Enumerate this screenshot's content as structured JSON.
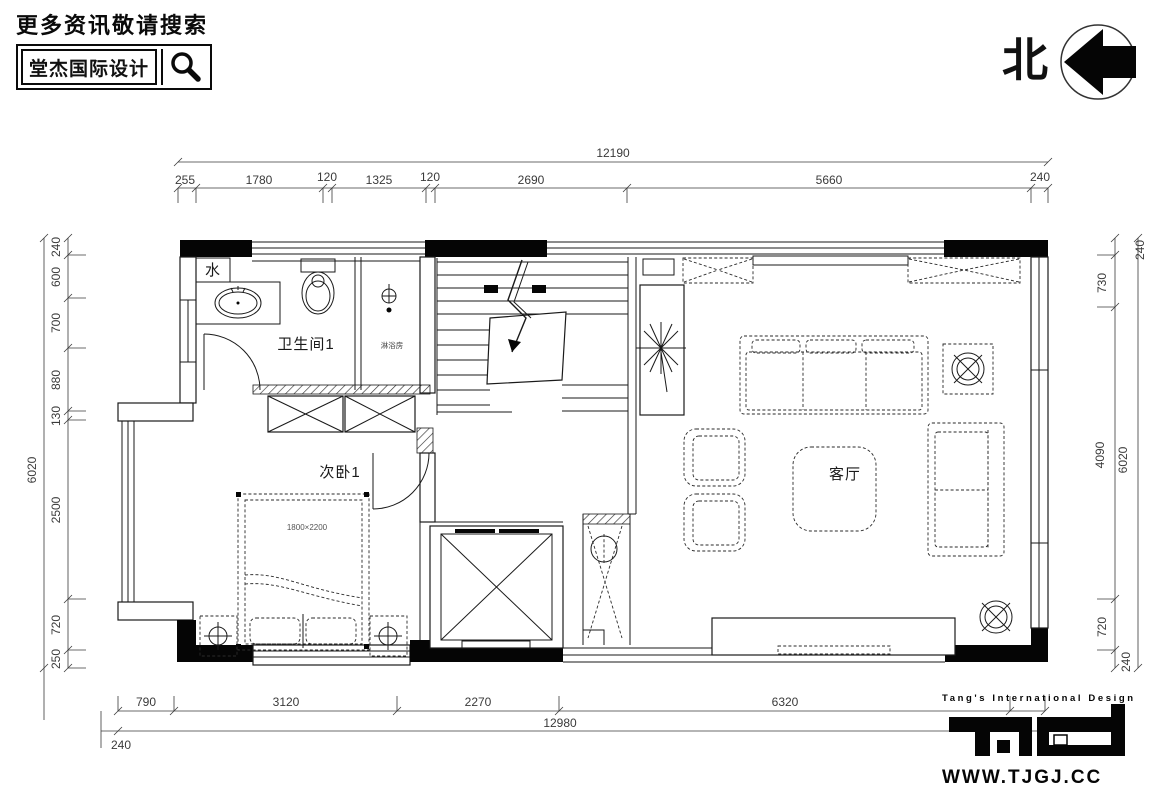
{
  "header": {
    "search_hint": "更多资讯敬请搜索",
    "brand": "堂杰国际设计"
  },
  "compass": {
    "label": "北"
  },
  "icons": {
    "search": "magnifier",
    "compass_arrow": "left-arrow-in-circle"
  },
  "colors": {
    "ink": "#1a1a1a",
    "dim_text": "#3a3a3a"
  },
  "rooms": {
    "water": "水",
    "bathroom": "卫生间1",
    "shower": "淋浴房",
    "bedroom": "次卧1",
    "bed_size": "1800×2200",
    "living": "客厅"
  },
  "dims": {
    "top_total": "12190",
    "top": [
      "255",
      "1780",
      "120",
      "1325",
      "120",
      "2690",
      "5660",
      "240"
    ],
    "left": [
      "240",
      "600",
      "700",
      "880",
      "130",
      "2500",
      "720",
      "250"
    ],
    "left_total": "6020",
    "right": [
      "240",
      "730",
      "4090",
      "720",
      "240"
    ],
    "right_total": "6020",
    "bottom": [
      "790",
      "3120",
      "2270",
      "6320"
    ],
    "bottom_total": "12980",
    "bottom_left": "240"
  },
  "footer": {
    "brand_text": "Tang's International Design",
    "website": "WWW.TJGJ.CC"
  }
}
